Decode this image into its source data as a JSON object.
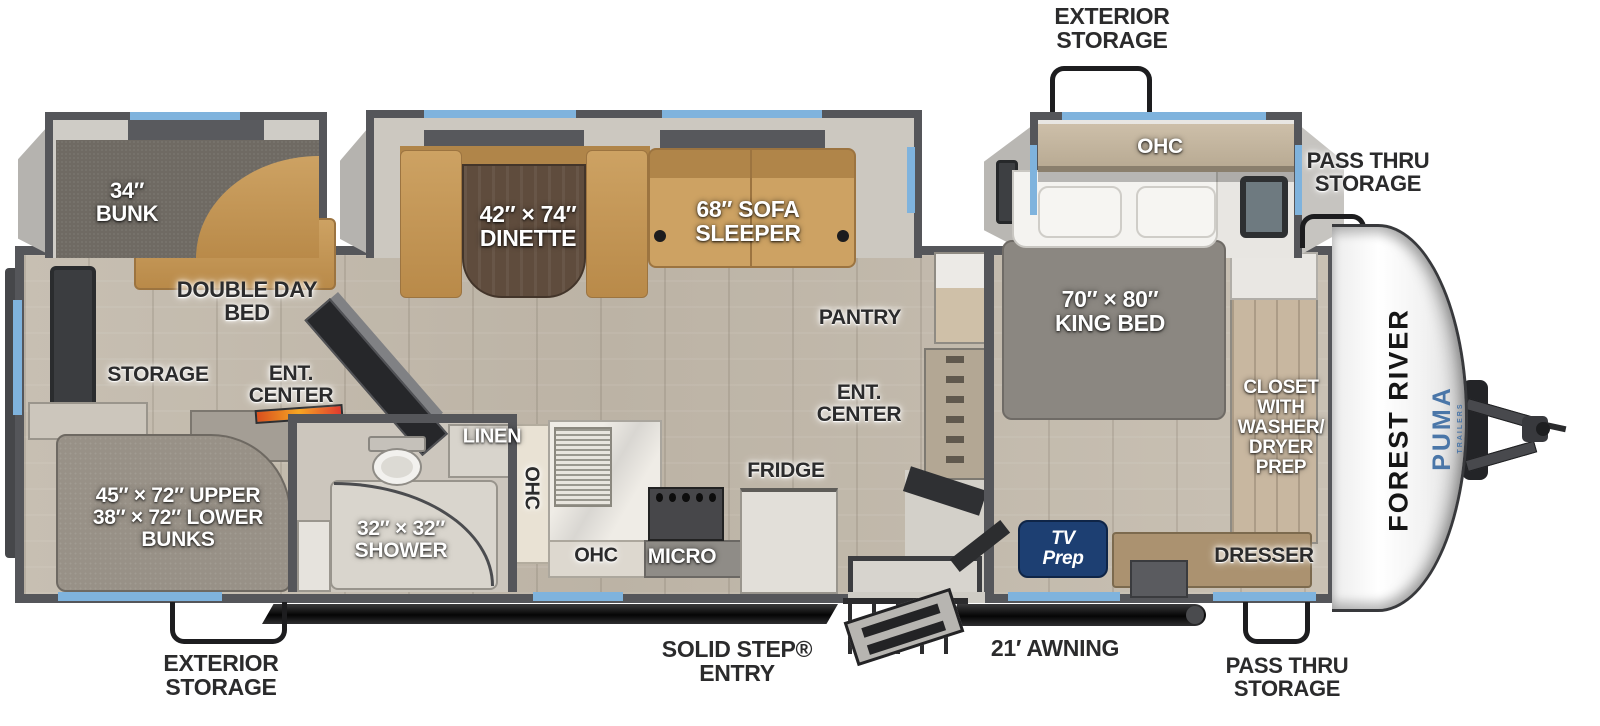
{
  "title": "Forest River Puma travel trailer floorplan",
  "colors": {
    "window_blue": "#7fb3dd",
    "tv_prep_navy": "#1d3f72",
    "puma_blue": "#4a76a8",
    "furniture_tan": "#c2975a",
    "wall_gray": "#55565a"
  },
  "brand": {
    "manufacturer": "FOREST RIVER",
    "model": "PUMA",
    "model_sub": "TRAILERS"
  },
  "labels": {
    "exterior_storage_top": "EXTERIOR\nSTORAGE",
    "pass_thru_storage_right": "PASS THRU\nSTORAGE",
    "exterior_storage_bottom": "EXTERIOR\nSTORAGE",
    "solid_step_entry": "SOLID STEP®\nENTRY",
    "awning_21ft": "21′ AWNING",
    "pass_thru_storage_bottom": "PASS THRU\nSTORAGE",
    "bunk_34": "34″\nBUNK",
    "dinette_42x74": "42″ × 74″\nDINETTE",
    "sofa_sleeper_68": "68″ SOFA\nSLEEPER",
    "ohc_bedroom": "OHC",
    "king_bed_70x80": "70″ × 80″\nKING BED",
    "closet_washer_dryer": "CLOSET\nWITH\nWASHER/\nDRYER\nPREP",
    "dresser": "DRESSER",
    "tv_prep": "TV\nPrep",
    "pantry": "PANTRY",
    "ent_center_main": "ENT.\nCENTER",
    "ent_center_rear": "ENT.\nCENTER",
    "double_day_bed": "DOUBLE DAY\nBED",
    "storage_rear": "STORAGE",
    "bunks_upper_lower": "45″ × 72″ UPPER\n38″ × 72″ LOWER\nBUNKS",
    "shower_32x32": "32″ × 32″\nSHOWER",
    "linen": "LINEN",
    "ohc_kitchen_wall": "OHC",
    "ohc_kitchen_counter": "OHC",
    "micro": "MICRO",
    "fridge": "FRIDGE"
  }
}
